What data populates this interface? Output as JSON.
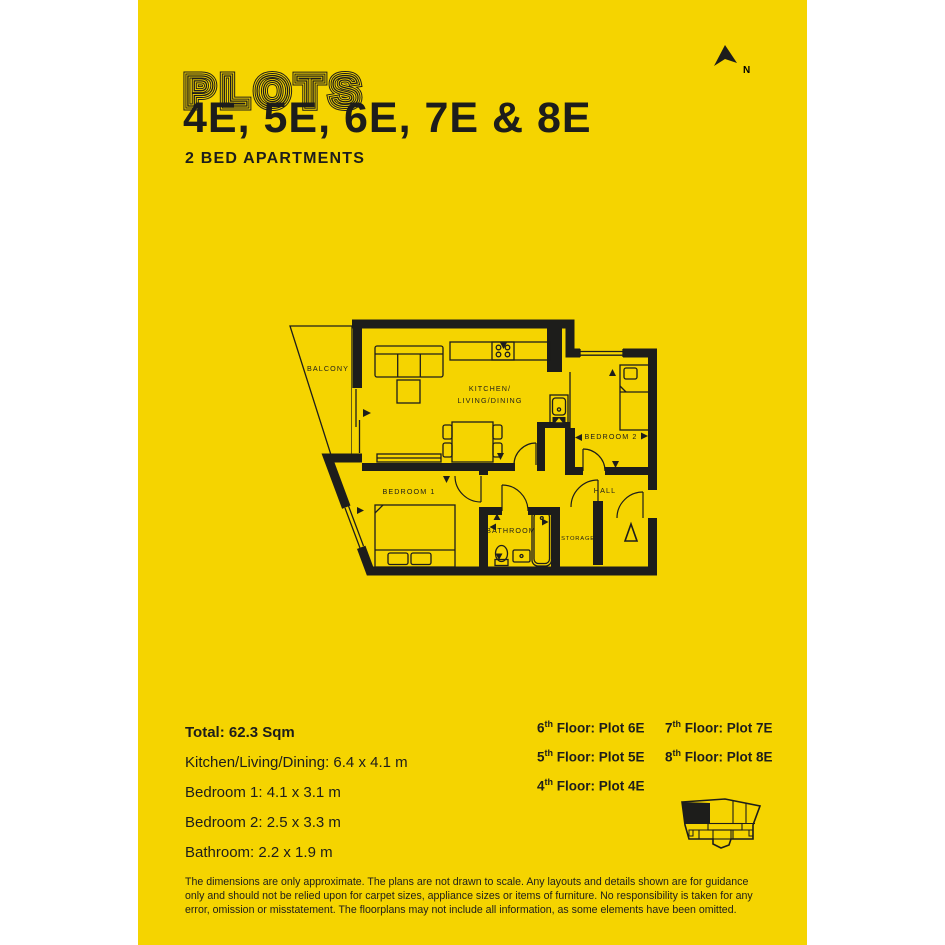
{
  "colors": {
    "background": "#f5d400",
    "ink": "#1d1d1b",
    "paper": "#ffffff"
  },
  "header": {
    "plots_label": "PLOTS",
    "plot_numbers": "4E, 5E, 6E, 7E & 8E",
    "subtitle": "2 BED APARTMENTS"
  },
  "north": {
    "label": "N"
  },
  "floorplan": {
    "labels": {
      "balcony": "BALCONY",
      "kitchen_line1": "KITCHEN/",
      "kitchen_line2": "LIVING/DINING",
      "bedroom2": "BEDROOM 2",
      "bedroom1": "BEDROOM 1",
      "hall": "HALL",
      "bathroom": "BATHROOM",
      "storage": "STORAGE"
    }
  },
  "dimensions": {
    "total": "Total: 62.3 Sqm",
    "items": [
      "Kitchen/Living/Dining: 6.4 x 4.1 m",
      "Bedroom 1: 4.1 x 3.1 m",
      "Bedroom 2: 2.5 x 3.3 m",
      "Bathroom: 2.2 x 1.9 m"
    ]
  },
  "floors": {
    "column1": [
      {
        "num": "6",
        "sup": "th",
        "rest": " Floor: Plot 6E"
      },
      {
        "num": "5",
        "sup": "th",
        "rest": " Floor: Plot 5E"
      },
      {
        "num": "4",
        "sup": "th",
        "rest": " Floor: Plot 4E"
      }
    ],
    "column2": [
      {
        "num": "7",
        "sup": "th",
        "rest": " Floor: Plot 7E"
      },
      {
        "num": "8",
        "sup": "th",
        "rest": " Floor: Plot 8E"
      }
    ]
  },
  "disclaimer": "The dimensions are only approximate. The plans are not drawn to scale. Any layouts and details shown are for guidance only and should not be relied upon for carpet sizes, appliance sizes or items of furniture. No responsibility is taken for any error, omission or misstatement. The floorplans may not include all information, as some elements have been omitted."
}
